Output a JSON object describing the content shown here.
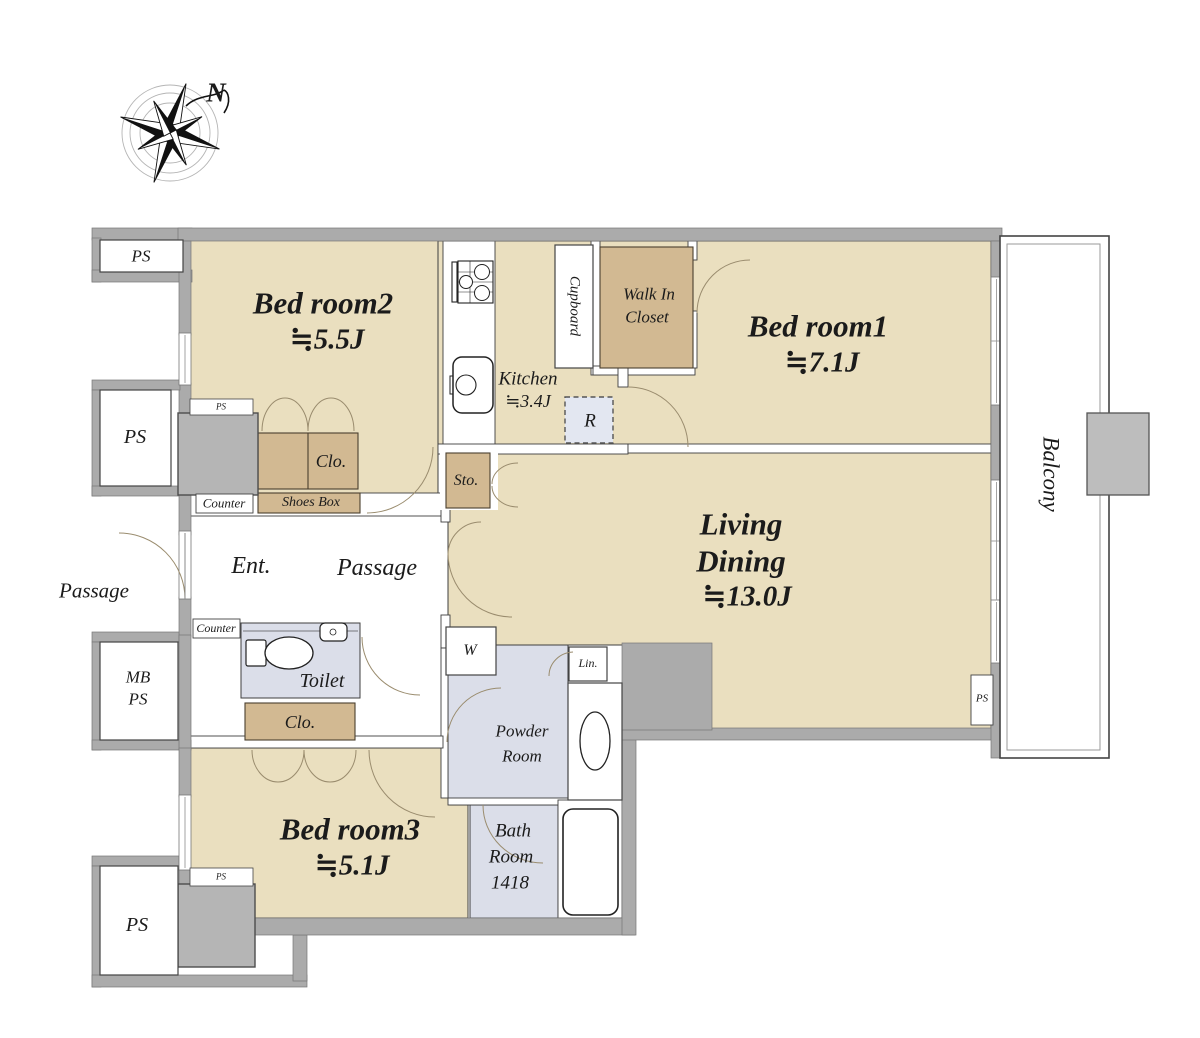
{
  "palette": {
    "room_fill": "#EADFBF",
    "closet_fill": "#D2B992",
    "wet_area_fill": "#DBDEE9",
    "wall_fill": "#ABABAB",
    "pillar_fill": "#B5B5B5",
    "refrigerator_fill": "#E3E7F1"
  },
  "compass": {
    "north": "N"
  },
  "rooms": {
    "bedroom2": {
      "name": "Bed room2",
      "area": "≒5.5J"
    },
    "bedroom1": {
      "name": "Bed room1",
      "area": "≒7.1J"
    },
    "bedroom3": {
      "name": "Bed room3",
      "area": "≒5.1J"
    },
    "living_dining": {
      "line1": "Living",
      "line2": "Dining",
      "area": "≒13.0J"
    },
    "kitchen": {
      "name": "Kitchen",
      "area": "≒3.4J"
    },
    "walk_in_closet": {
      "line1": "Walk In",
      "line2": "Closet"
    },
    "cupboard": {
      "name": "Cupboard"
    },
    "balcony": {
      "name": "Balcony"
    },
    "powder_room": {
      "line1": "Powder",
      "line2": "Room"
    },
    "bath_room": {
      "line1": "Bath",
      "line2": "Room",
      "size": "1418"
    },
    "toilet": {
      "name": "Toilet"
    },
    "entrance": {
      "name": "Ent."
    },
    "passage": {
      "name": "Passage"
    },
    "outside_passage": {
      "name": "Passage"
    }
  },
  "storage": {
    "closet_abbr": "Clo.",
    "shoes_box": "Shoes Box",
    "storage_abbr": "Sto.",
    "linen_abbr": "Lin."
  },
  "fixtures": {
    "refrigerator": "R",
    "washer": "W",
    "counter": "Counter"
  },
  "shafts": {
    "ps": "PS",
    "mb_line1": "MB",
    "mb_line2": "PS"
  }
}
